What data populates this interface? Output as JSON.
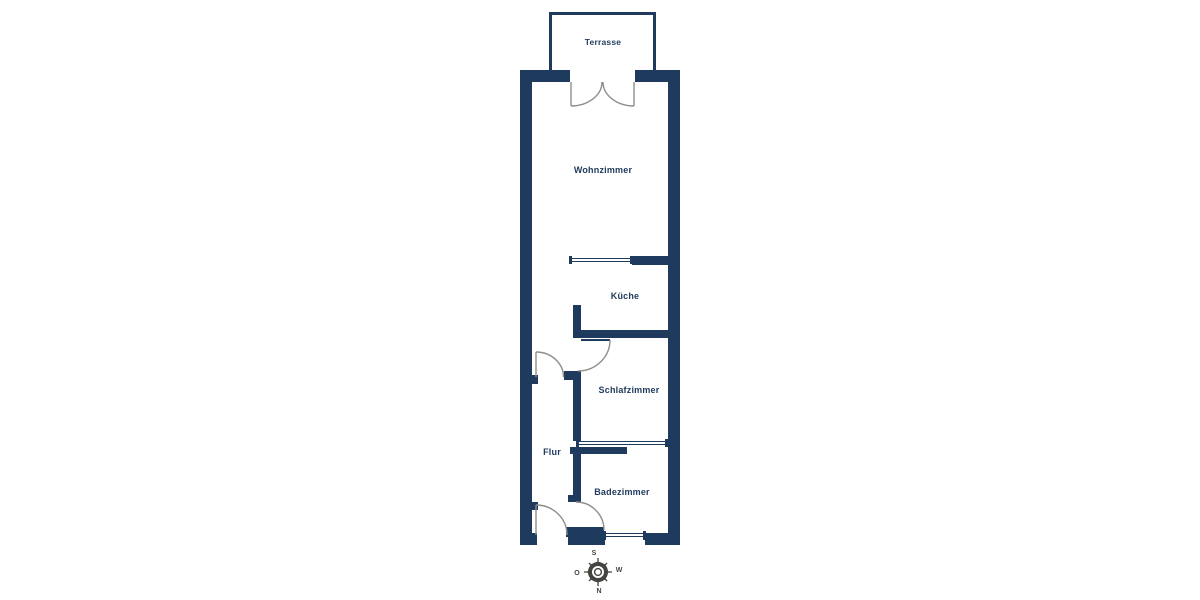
{
  "title": "Apartment floor plan",
  "colors": {
    "wall": "#1e3a5c",
    "door_line": "#8e8f8c",
    "text": "#1e3a5c",
    "compass": "#45453f"
  },
  "rooms": [
    {
      "id": "terrasse",
      "label": "Terrasse"
    },
    {
      "id": "wohnzimmer",
      "label": "Wohnzimmer"
    },
    {
      "id": "kueche",
      "label": "Küche"
    },
    {
      "id": "schlafzimmer",
      "label": "Schlafzimmer"
    },
    {
      "id": "flur",
      "label": "Flur"
    },
    {
      "id": "badezimmer",
      "label": "Badezimmer"
    }
  ],
  "compass": {
    "top": "S",
    "left": "O",
    "right": "W",
    "bottom": "N"
  }
}
